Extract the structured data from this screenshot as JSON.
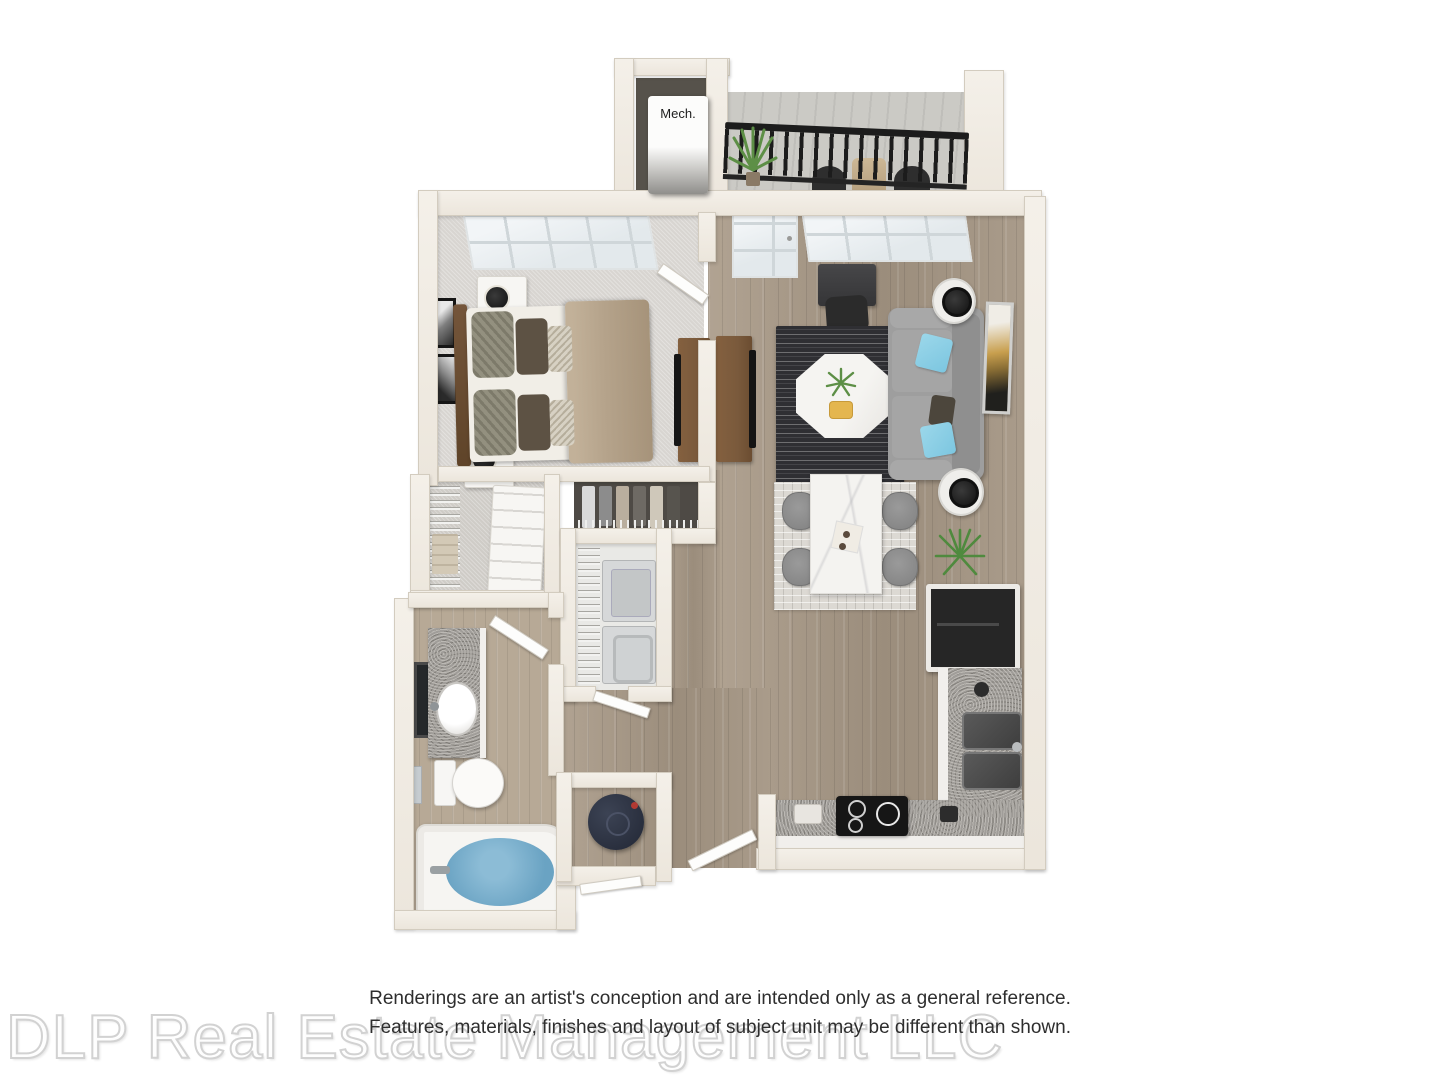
{
  "labels": {
    "mech": "Mech."
  },
  "disclaimer": {
    "line1": "Renderings are an artist's conception and are intended only as a general reference.",
    "line2": "Features, materials, finishes and layout of subject unit may be different than shown."
  },
  "watermark": "DLP Real Estate Management LLC",
  "colors": {
    "wall": "#ece6dc",
    "wall_edge": "#d3ccbf",
    "carpet": "#d8d5d1",
    "wood": "#a69884",
    "wood_light": "#b7a996",
    "balcony": "#cbcac5",
    "granite": "#a09d99",
    "sofa": "#9e9e9e",
    "accent_blue": "#7cc6e0",
    "rug_dark": "#2f2f33",
    "bed_tan": "#b5a38b",
    "furniture_wood": "#7a5a3c",
    "railing": "#1c1c1c",
    "water": "#6aa3c3",
    "appliance_dark": "#262626"
  }
}
